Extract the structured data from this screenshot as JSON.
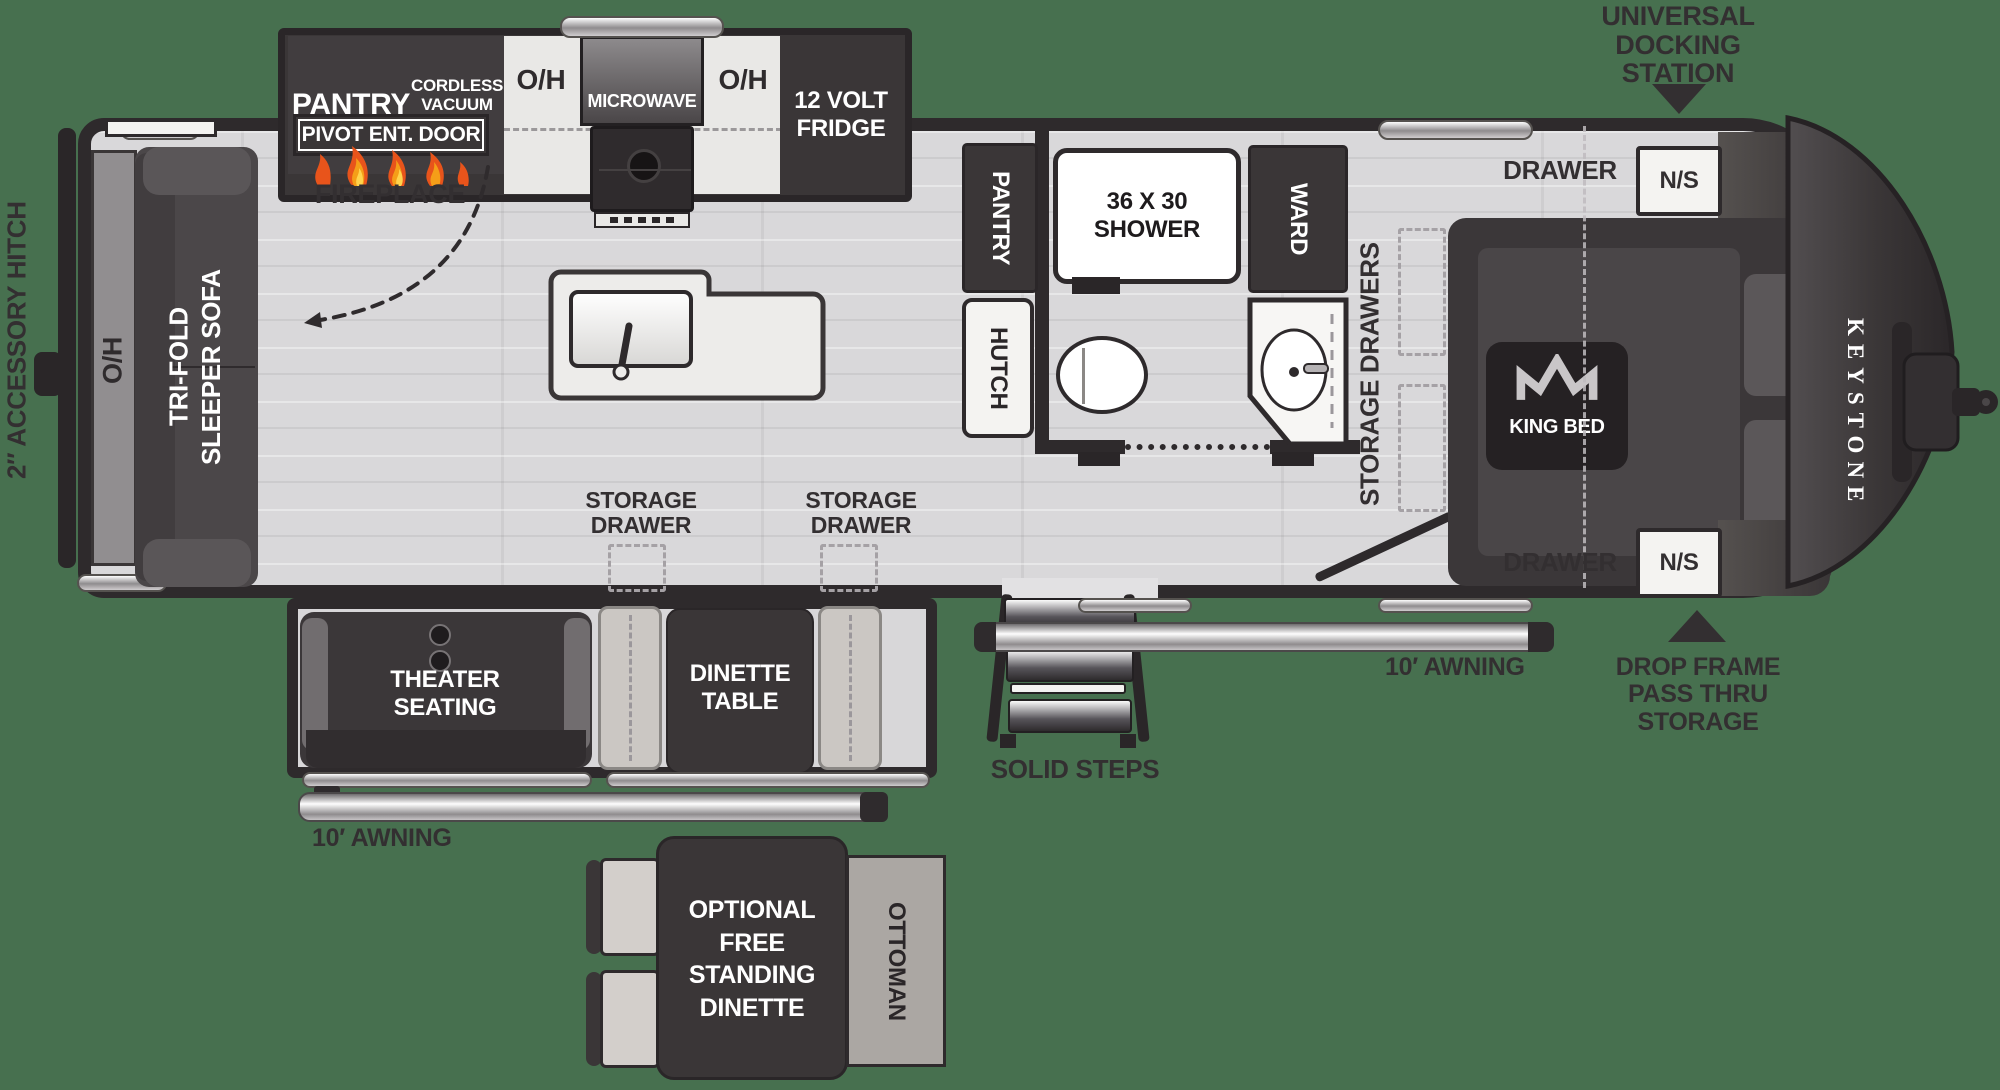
{
  "exterior": {
    "accessory_hitch": "2″ ACCESSORY HITCH",
    "docking_station": "UNIVERSAL\nDOCKING\nSTATION",
    "drop_frame": "DROP FRAME\nPASS THRU\nSTORAGE",
    "awning_left": "10′ AWNING",
    "awning_right": "10′ AWNING",
    "solid_steps": "SOLID STEPS",
    "brand": "KEYSTONE"
  },
  "galley": {
    "pantry": "PANTRY",
    "vacuum_prep": "CORDLESS\nVACUUM\nPREP",
    "oh_left": "O/H",
    "microwave": "MICROWAVE",
    "oh_right": "O/H",
    "fridge": "12 VOLT\nFRIDGE",
    "pivot_door": "PIVOT ENT. DOOR",
    "fireplace": "FIREPLACE"
  },
  "living": {
    "oh_rear": "O/H",
    "sleeper_sofa": "TRI-FOLD\nSLEEPER SOFA",
    "storage_drawer_left": "STORAGE\nDRAWER",
    "storage_drawer_right": "STORAGE\nDRAWER",
    "theater_seating": "THEATER\nSEATING",
    "dinette_table": "DINETTE\nTABLE"
  },
  "bath": {
    "pantry": "PANTRY",
    "hutch": "HUTCH",
    "shower": "36 X 30\nSHOWER",
    "ward": "WARD"
  },
  "bedroom": {
    "storage_drawers": "STORAGE DRAWERS",
    "drawer_top": "DRAWER",
    "drawer_bottom": "DRAWER",
    "nightstand_top": "N/S",
    "nightstand_bottom": "N/S",
    "king_bed": "KING BED"
  },
  "optional": {
    "free_standing_dinette": "OPTIONAL\nFREE\nSTANDING\nDINETTE",
    "ottoman": "OTTOMAN"
  },
  "colors": {
    "background": "#47704F",
    "wall": "#2E2A2C",
    "furniture_dark": "#3A3637",
    "floor": "#D9D8DA",
    "flame": "#E8541B"
  }
}
